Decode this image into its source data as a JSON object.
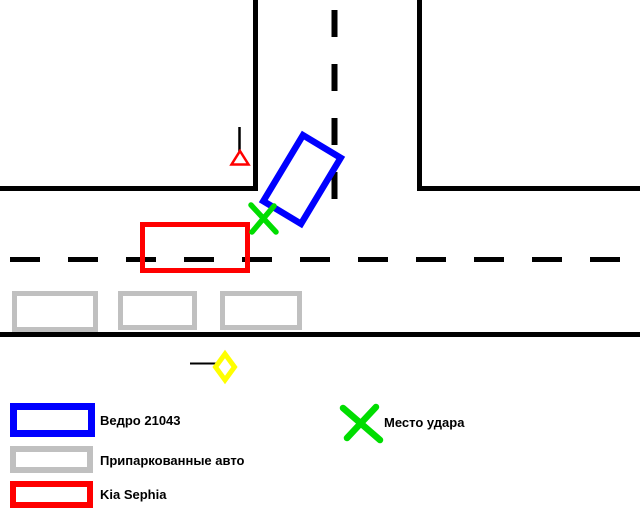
{
  "legend": {
    "items": [
      {
        "id": "vedro",
        "label": "Ведро 21043",
        "swatch": "blue-rectangle"
      },
      {
        "id": "parked",
        "label": "Припаркованные авто",
        "swatch": "gray-rectangle"
      },
      {
        "id": "kia",
        "label": "Kia Sephia",
        "swatch": "red-rectangle"
      },
      {
        "id": "impact",
        "label": "Место удара",
        "swatch": "green-x"
      }
    ]
  },
  "colors": {
    "vedro_blue": "#0000FF",
    "parked_gray": "#C0C0C0",
    "kia_red": "#FF0000",
    "impact_green": "#00DD00",
    "sign_yellow": "#FFFF00",
    "road_black": "#000000",
    "background": "#FFFFFF"
  },
  "diagram": {
    "type": "road-accident-scheme",
    "parked_cars_count": 3,
    "vehicles": [
      "vedro-21043-car",
      "kia-sephia-car"
    ],
    "signs": [
      "yield-triangle-sign",
      "main-road-diamond-sign"
    ],
    "marks": [
      "impact-x-mark"
    ]
  }
}
